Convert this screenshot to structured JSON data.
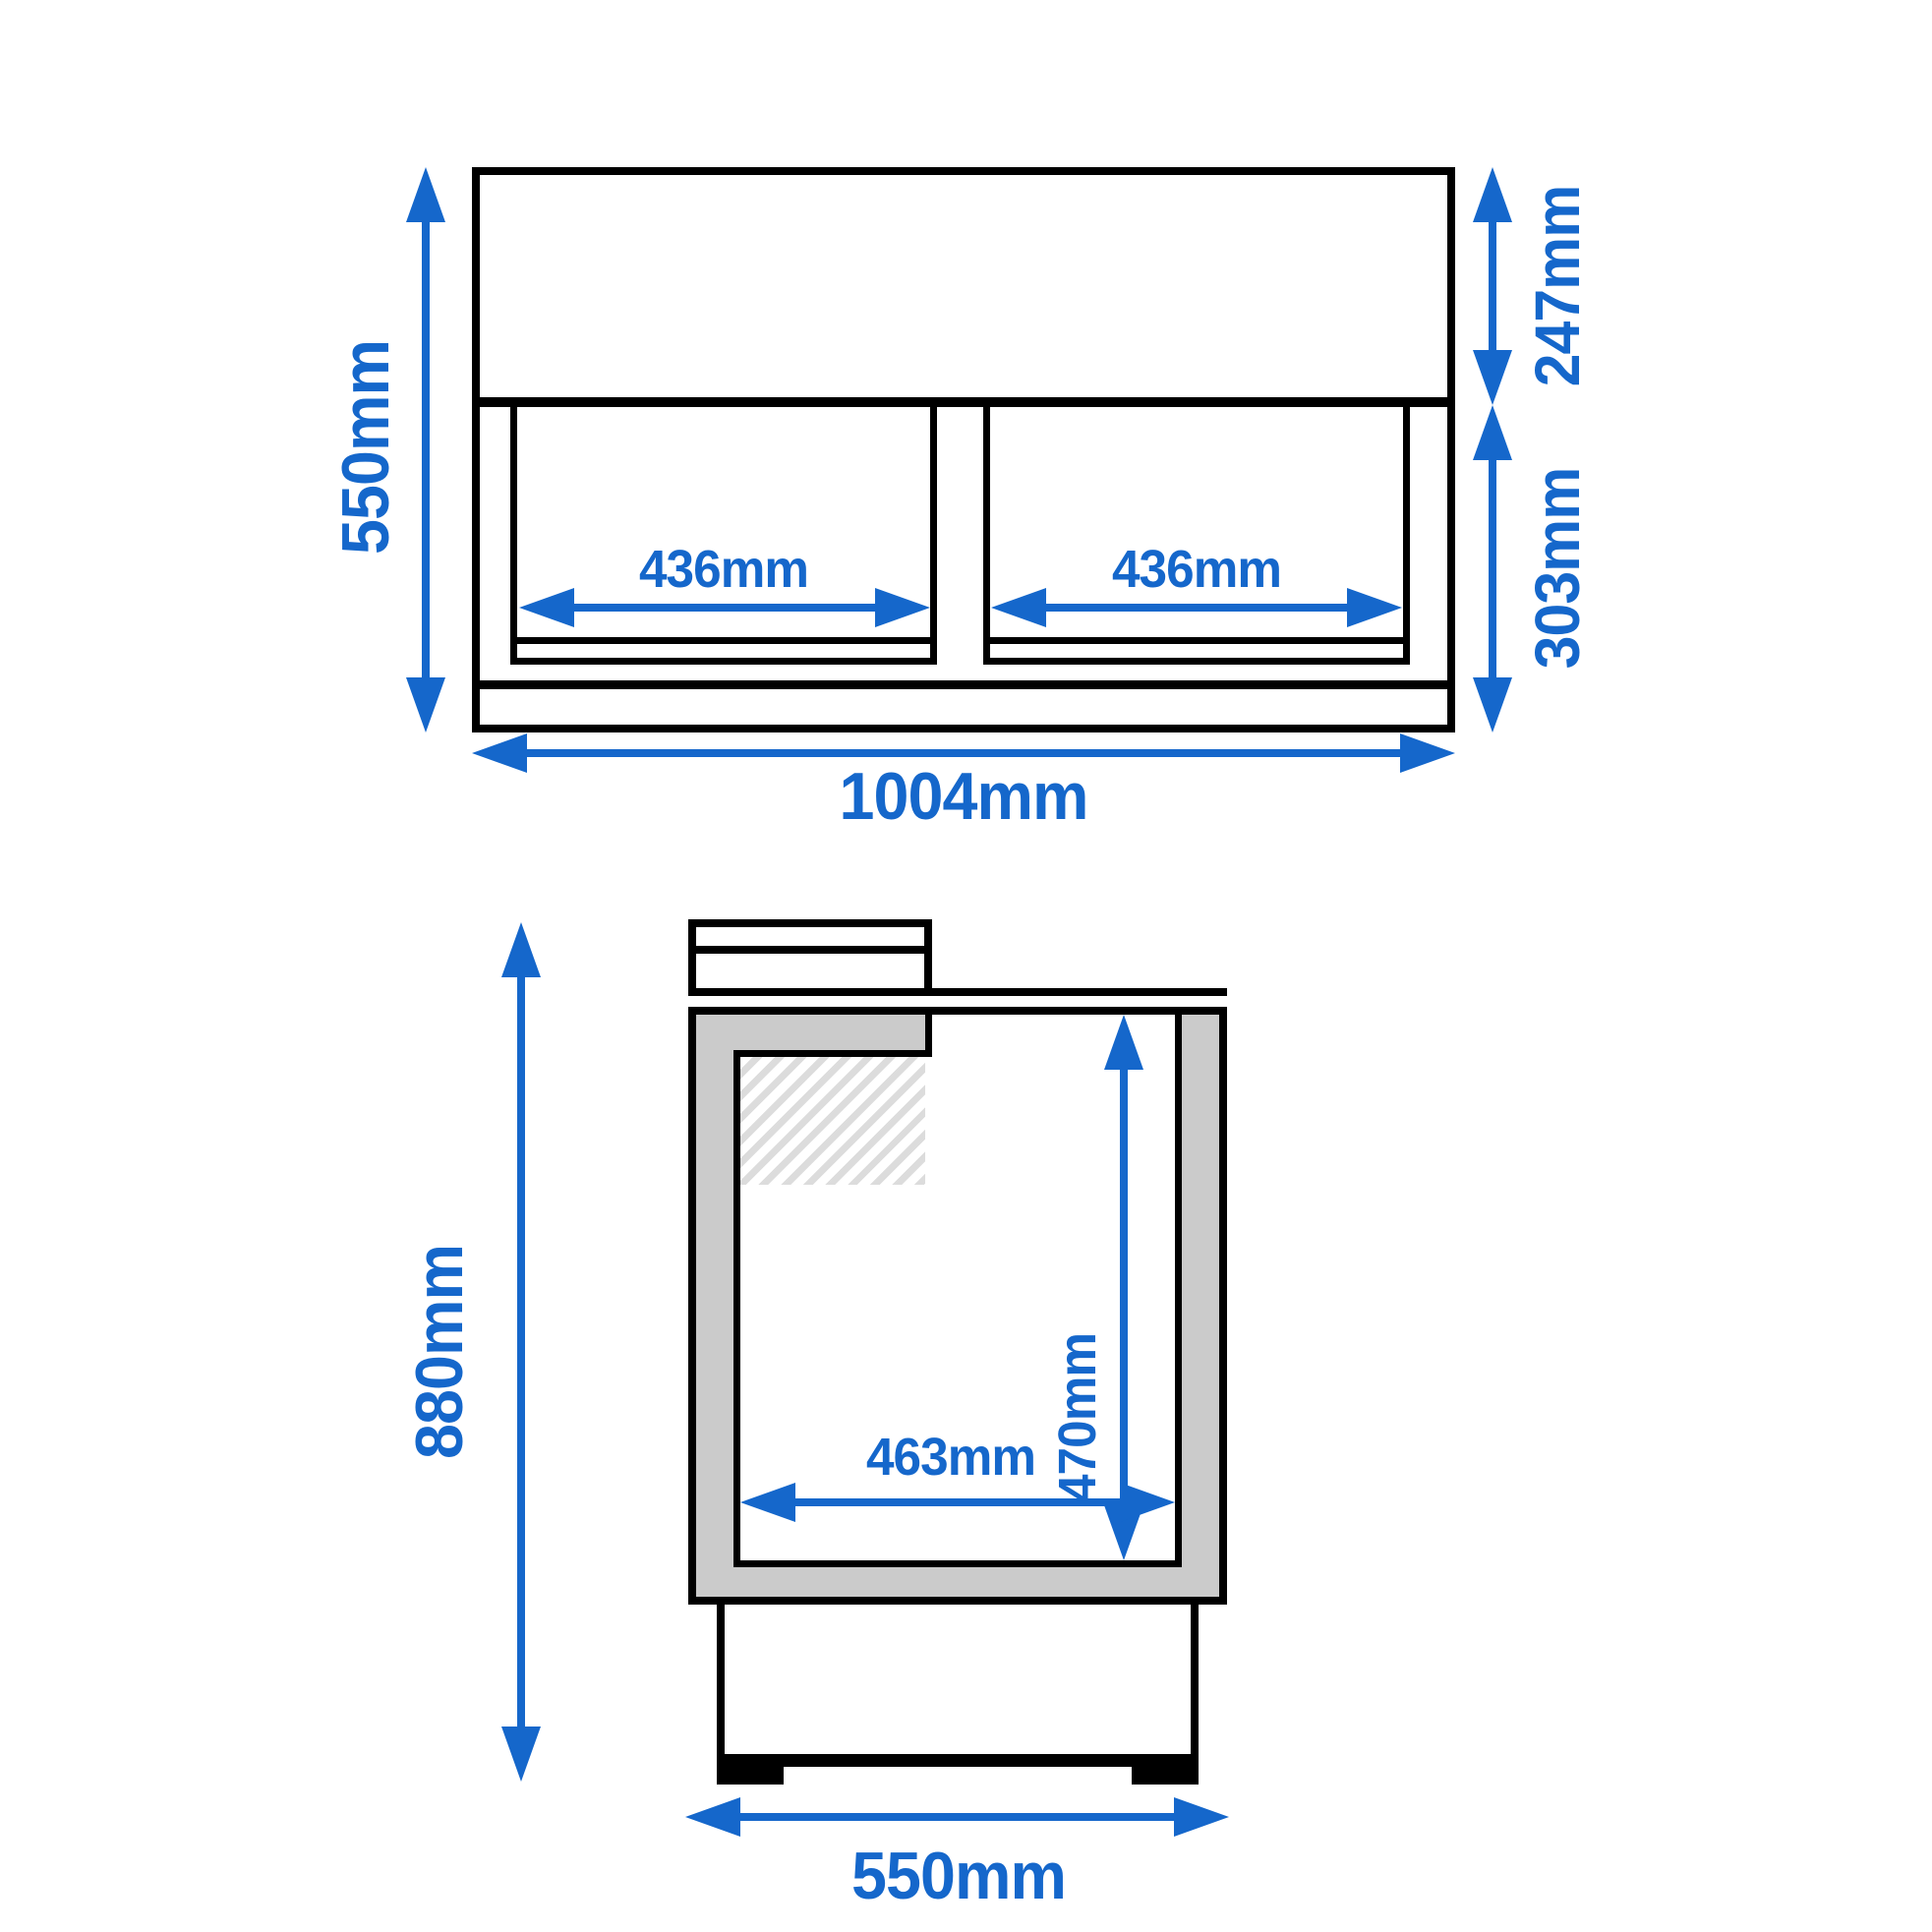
{
  "document": {
    "type": "technical-drawing",
    "subject": "two-door counter unit, dimensioned front and side views"
  },
  "colors": {
    "dimension_blue": "#1567CB",
    "line_black": "#000000",
    "insulation_gray": "#CBCBCB",
    "hatch_gray": "#DCDCDC",
    "background": "#FFFFFF"
  },
  "views": {
    "front": {
      "label": "front-view",
      "dimensions": {
        "overall_height": "550mm",
        "top_section_height": "247mm",
        "bottom_section_height": "303mm",
        "left_opening_width": "436mm",
        "right_opening_width": "436mm",
        "overall_width": "1004mm"
      }
    },
    "side": {
      "label": "side-view",
      "dimensions": {
        "overall_height": "880mm",
        "inner_height": "470mm",
        "inner_width": "463mm",
        "overall_depth": "550mm"
      }
    }
  }
}
